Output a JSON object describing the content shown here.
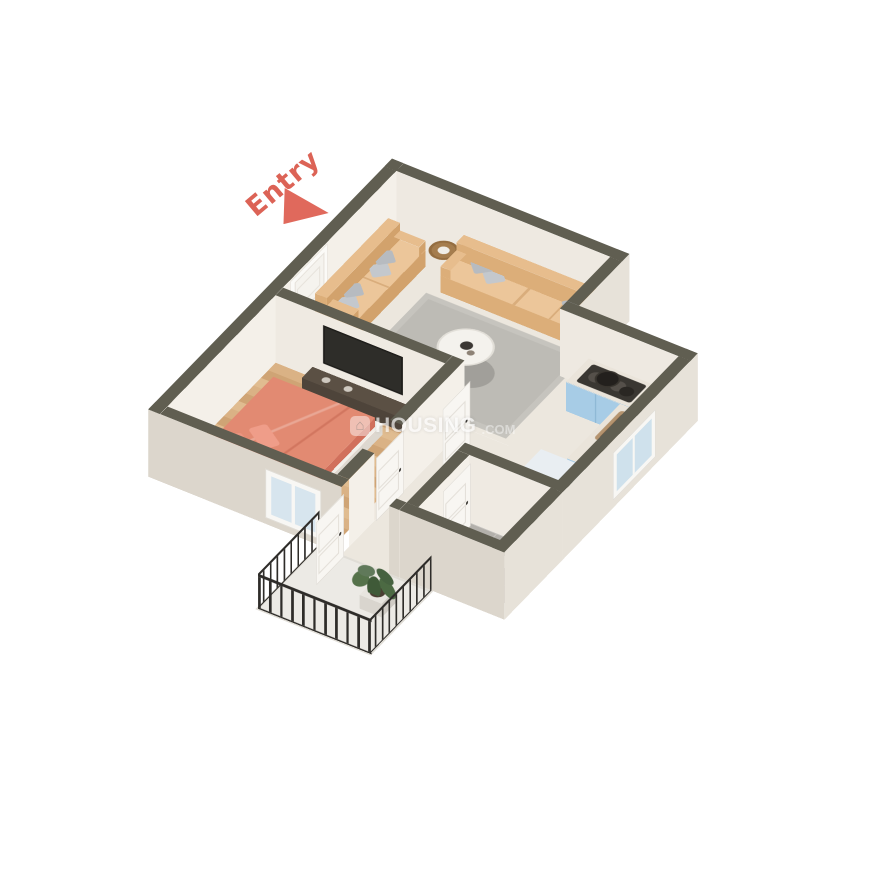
{
  "entry": {
    "label": "Entry"
  },
  "watermark": {
    "icon_glyph": "⌂",
    "name": "HOUSING",
    "suffix": ".COM"
  },
  "palette": {
    "accent": "#df6a5b",
    "wall_top": "#605e51",
    "wall_face_interior": "#f3efe8",
    "wall_face_exterior": "#e7e2d9",
    "wood_floor": "#d5ac7d",
    "tile_floor": "#b3b0ab",
    "living_floor": "#ece7de",
    "bed_duvet": "#e28a72",
    "sofa": "#e7bd8d",
    "cushion": "#b7bbc0",
    "kitchen_cabinet": "#a7cce6",
    "rug": "#bdbbb5",
    "railing": "#2e2c29",
    "tv": "#2e2d29",
    "background": "#ffffff"
  },
  "rooms": [
    {
      "name": "living-room",
      "furniture": [
        "sofa-3-seater",
        "sofa-2-seater",
        "corner-side-table",
        "round-coffee-table",
        "area-rug"
      ]
    },
    {
      "name": "bedroom",
      "furniture": [
        "double-bed-coral",
        "headboard",
        "nightstand",
        "tv-console",
        "wall-tv"
      ]
    },
    {
      "name": "kitchen",
      "furniture": [
        "counter-with-stove",
        "sink-counter",
        "refrigerator-blue",
        "window"
      ]
    },
    {
      "name": "bathroom",
      "furniture": [
        "toilet",
        "washbasin",
        "shower"
      ]
    },
    {
      "name": "hallway",
      "furniture": [
        "doors"
      ]
    },
    {
      "name": "balcony",
      "furniture": [
        "metal-railing",
        "potted-plant"
      ]
    }
  ]
}
